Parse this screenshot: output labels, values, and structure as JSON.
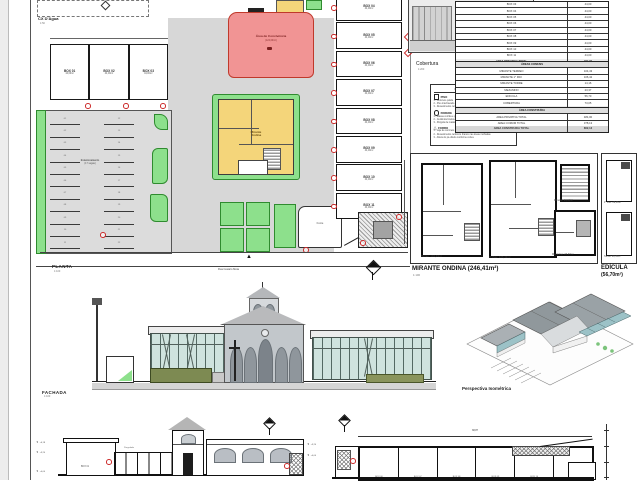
{
  "colors": {
    "red_fill": "#f19494",
    "red_border": "#c0392b",
    "yellow_fill": "#f4d57a",
    "green_fill": "#8de08c",
    "green_border": "#2f8b2f",
    "glass": "#cfe3de",
    "paving": "#dcdcdc",
    "plaza": "#d7d7d7",
    "roof_gray": "#9aa2a6"
  },
  "planta": {
    "title": "PLANTA",
    "scale": "1:100",
    "cx_dagua": {
      "label": "CX D'Água",
      "scale": "1:50"
    },
    "street_label": "Rua Cesário Mota",
    "north_glyph": "▲",
    "convivencia": {
      "line1": "Área de Convivência",
      "line2": "(124,00m²)"
    },
    "mirante": {
      "line1": "Mirante",
      "line2": "Ondina"
    },
    "estacionamento": {
      "line1": "Estacionamento",
      "line2": "(17 vagas)"
    },
    "fonte_label": "Fonte",
    "top_rooms": [
      {
        "label": "BOX 01",
        "area": "44,00m²"
      },
      {
        "label": "BOX 02",
        "area": "44,00m²"
      },
      {
        "label": "BOX 03",
        "area": "44,00m²"
      }
    ],
    "box_rows": [
      {
        "label": "BOX 04",
        "area": "44,00m²"
      },
      {
        "label": "BOX 05",
        "area": "44,00m²"
      },
      {
        "label": "BOX 06",
        "area": "44,00m²"
      },
      {
        "label": "BOX 07",
        "area": "44,00m²"
      },
      {
        "label": "BOX 08",
        "area": "44,00m²"
      },
      {
        "label": "BOX 09",
        "area": "44,00m²"
      },
      {
        "label": "BOX 10",
        "area": "44,00m²"
      },
      {
        "label": "BOX 11",
        "area": "44,00m²"
      }
    ],
    "stalls_left": [
      "01",
      "02",
      "03",
      "04",
      "05",
      "06",
      "07",
      "08",
      "09",
      "10",
      "11"
    ],
    "stalls_right": [
      "12",
      "13",
      "14",
      "15",
      "16",
      "17",
      "18",
      "19",
      "20",
      "21",
      "22"
    ]
  },
  "cobertura": {
    "title": "Cobertura",
    "scale": "1:200",
    "street_label": "RUA CESÁRIO MOTA"
  },
  "legend": {
    "title": "LISTA DE ACABAMENTOS",
    "piso": {
      "title": "PISO",
      "items": [
        "1 - Concreto polido",
        "2 - Piso intertravado de concreto",
        "3 - Revestimento cerâmico 60x60 cinza claro"
      ]
    },
    "parede": {
      "title": "PAREDE",
      "items": [
        "1 - Massa corrida e pintura acrílica branca",
        "2 - Cerâmica branca 10x10 até h=1,80m",
        "3 - Pérgola de madeira de reflorestamento"
      ]
    },
    "forro": {
      "title": "FORRO",
      "items": [
        "1 - Laje de concreto aparente",
        "2 - Revestimento cerâmico branco nas áreas molhadas",
        "3 - Altura do pé-direito conforme cortes"
      ]
    }
  },
  "area_tables": {
    "privativas": {
      "rows": [
        {
          "label": "BOX 03",
          "value": "44,00"
        },
        {
          "label": "BOX 04",
          "value": "44,00"
        },
        {
          "label": "BOX 05",
          "value": "44,00"
        },
        {
          "label": "BOX 06",
          "value": "44,00"
        },
        {
          "label": "BOX 07",
          "value": "44,00"
        },
        {
          "label": "BOX 08",
          "value": "44,00"
        },
        {
          "label": "BOX 09",
          "value": "44,00"
        },
        {
          "label": "BOX 10",
          "value": "44,00"
        },
        {
          "label": "BOX 11",
          "value": "44,00"
        }
      ],
      "total_label": "ÁREA PRIVATIVA TOTAL",
      "total_value": "484,00"
    },
    "comuns": {
      "header": "ÁREAS COMUNS",
      "rows": [
        {
          "label": "MIRANTE TÉRREO",
          "value": "104,43"
        },
        {
          "label": "MIRANTE 1° PAV.",
          "value": "106,42"
        },
        {
          "label": "MIRANTE TORRE",
          "value": "14,16"
        },
        {
          "label": "MEZANINO",
          "value": "23,37"
        },
        {
          "label": "EDÍCULA",
          "value": "56,70"
        },
        {
          "label": "COBERTURA",
          "value": "73,05"
        }
      ],
      "total_label": "ÁREA COMUM TOTAL",
      "total_value": "378,13"
    },
    "construida": {
      "header": "ÁREA CONSTRUÍDA",
      "rows": [
        {
          "label": "ÁREA PRIVATIVA TOTAL",
          "value": "484,00"
        },
        {
          "label": "ÁREA COMUM TOTAL",
          "value": "378,13"
        }
      ],
      "total_label": "ÁREA CONSTRUÍDA TOTAL",
      "total_value": "862,13"
    }
  },
  "mirante_panel": {
    "title": "MIRANTE ONDINA (246,41m²)",
    "scale": "1:100",
    "terreo_label": "Térreo: 104,43m²",
    "pav1_label": "1° Pav.: 106,42m²",
    "mirante_label": "Mirante: 14,16m²",
    "mezanino_label": "Mezanino: 23,37m²"
  },
  "edicula_panel": {
    "title": "EDÍCULA",
    "subtitle": "(56,70m²)",
    "pav1_label": "1° Pav.: 28,35m²",
    "terreo_label": "Térreo: 28,35m²"
  },
  "fachada": {
    "title": "FACHADA",
    "scale": "1:100"
  },
  "perspectiva": {
    "title": "Perspectiva Isométrica"
  },
  "cortes": {
    "dim_total": "38,87",
    "left_room_label": "BOX 01",
    "pergola_label": "Pergolado",
    "cells": [
      "BOX 06",
      "BOX 07",
      "BOX 08",
      "BOX 09",
      "BOX 10",
      "BOX 11"
    ],
    "levels_left": [
      "+6,18",
      "+3,20",
      "+0,00"
    ],
    "levels_mid": [
      "+3,20",
      "+0,00"
    ]
  }
}
